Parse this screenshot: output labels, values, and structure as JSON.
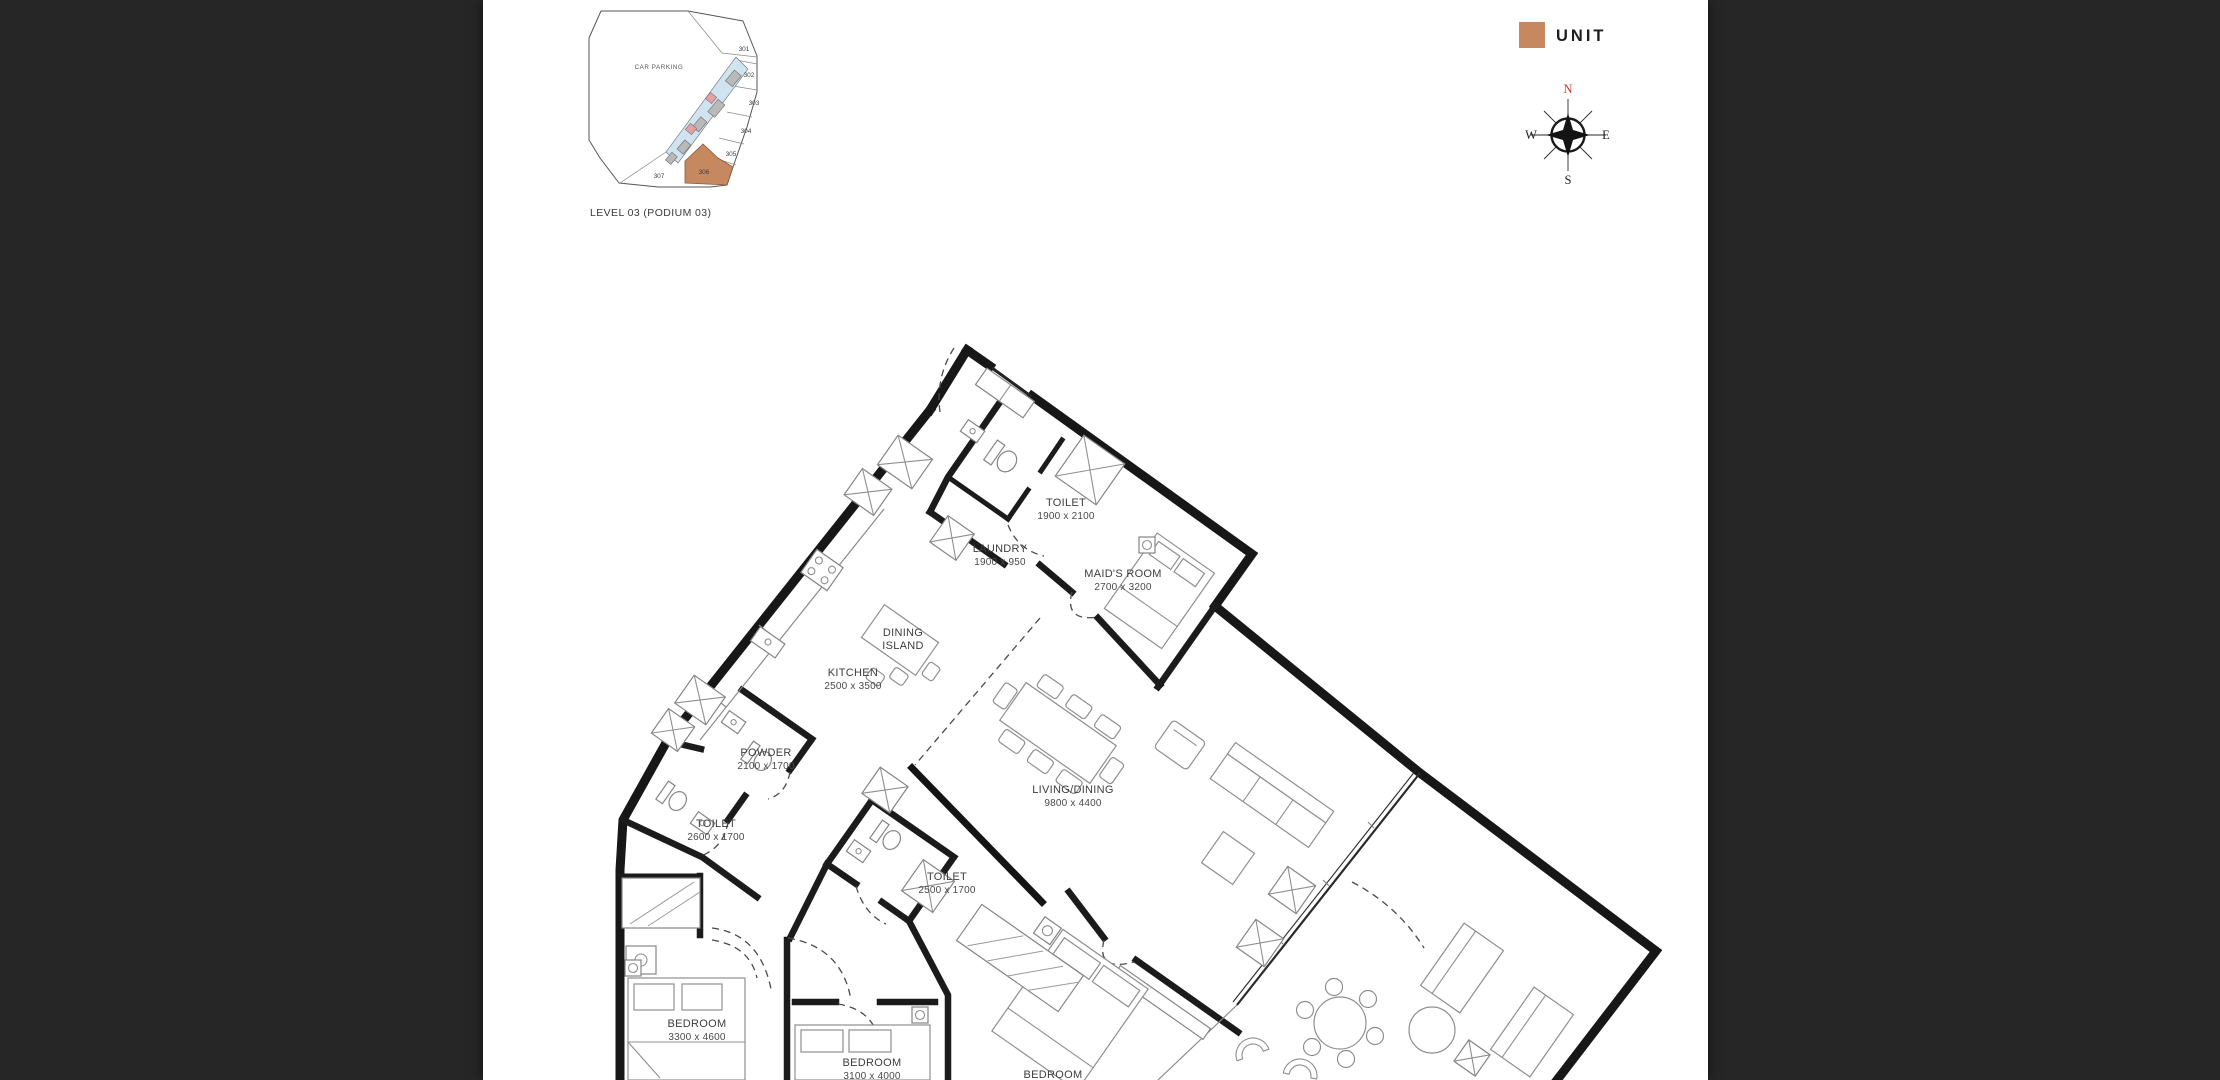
{
  "viewer": {
    "background": "#262626",
    "page_background": "#ffffff"
  },
  "keyplan": {
    "car_parking_label": "CAR PARKING",
    "level_label": "LEVEL 03 (PODIUM 03)",
    "units": [
      "301",
      "302",
      "303",
      "304",
      "305",
      "306",
      "307"
    ],
    "highlighted_unit": "306",
    "colors": {
      "unit_highlight": "#C6895F",
      "corridor": "#CFE3F1",
      "core": "#B9B9B9",
      "amenity": "#E6A2A2"
    }
  },
  "legend": {
    "label": "UNIT",
    "swatch_color": "#C6895F"
  },
  "compass": {
    "north": "N",
    "east": "E",
    "south": "S",
    "west": "W",
    "north_color": "#C0392B"
  },
  "floorplan": {
    "rooms": [
      {
        "name": "TOILET",
        "dims": "1900 x 2100"
      },
      {
        "name": "LAUNDRY",
        "dims": "1900 x 950"
      },
      {
        "name": "MAID'S ROOM",
        "dims": "2700 x 3200"
      },
      {
        "name": "DINING",
        "dims": "ISLAND"
      },
      {
        "name": "KITCHEN",
        "dims": "2500 x 3500"
      },
      {
        "name": "POWDER",
        "dims": "2100 x 1700"
      },
      {
        "name": "TOILET",
        "dims": "2600 x 1700"
      },
      {
        "name": "TOILET",
        "dims": "2500 x 1700"
      },
      {
        "name": "LIVING/DINING",
        "dims": "9800 x 4400"
      },
      {
        "name": "BEDROOM",
        "dims": "3300 x 4600"
      },
      {
        "name": "BEDROOM",
        "dims": "3100 x 4000"
      },
      {
        "name": "BEDROOM",
        "dims": ""
      }
    ]
  }
}
